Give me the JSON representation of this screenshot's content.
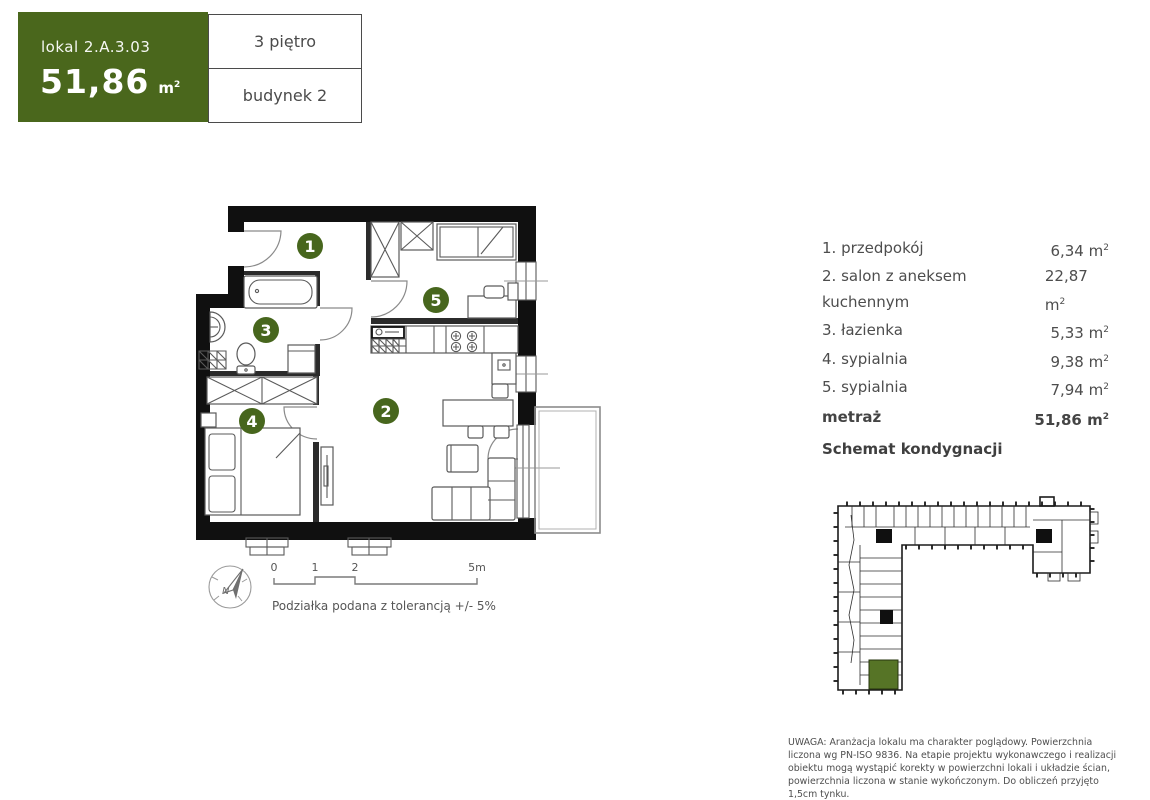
{
  "header": {
    "unit_label": "lokal 2.A.3.03",
    "area_value": "51,86",
    "floor": "3 piętro",
    "building": "budynek 2"
  },
  "units": {
    "m": "m",
    "exp": "2"
  },
  "rooms": [
    {
      "label": "1. przedpokój",
      "area": "6,34"
    },
    {
      "label": "2. salon z aneksem kuchennym",
      "area": "22,87"
    },
    {
      "label": "3. łazienka",
      "area": "5,33"
    },
    {
      "label": "4. sypialnia",
      "area": "9,38"
    },
    {
      "label": "5. sypialnia",
      "area": "7,94"
    }
  ],
  "total": {
    "label": "metraż",
    "area": "51,86"
  },
  "plan": {
    "labels": [
      "1",
      "2",
      "3",
      "4",
      "5"
    ]
  },
  "sections": {
    "schematic_title": "Schemat kondygnacji"
  },
  "scale": {
    "t0": "0",
    "t1": "1",
    "t2": "2",
    "t5": "5m",
    "compass": "N",
    "note": "Podziałka podana z tolerancją +/- 5%"
  },
  "disclaimer": "UWAGA: Aranżacja lokalu ma charakter poglądowy. Powierzchnia liczona wg PN-ISO 9836. Na etapie projektu wykonawczego i realizacji obiektu mogą wystąpić korekty w powierzchni lokali i układzie ścian, powierzchnia liczona w stanie wykończonym. Do obliczeń przyjęto 1,5cm tynku.",
  "colors": {
    "brand_green": "#4a671c",
    "room_badge_green": "#47661d",
    "unit_highlight_green": "#567426"
  }
}
